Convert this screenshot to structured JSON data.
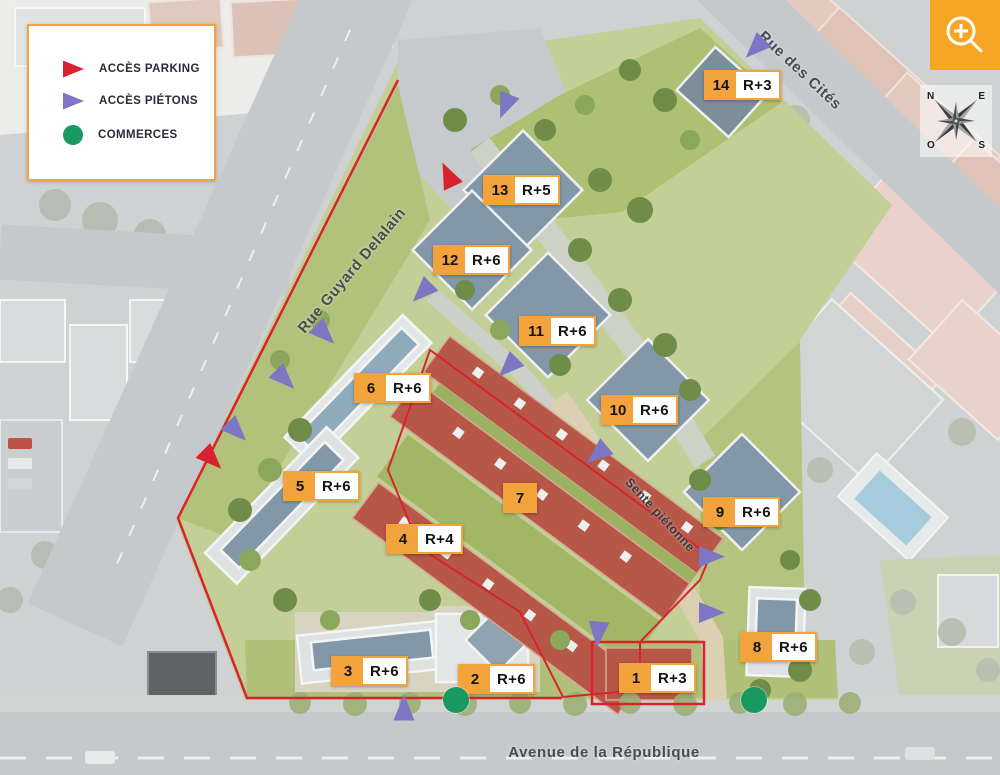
{
  "legend": {
    "items": [
      {
        "name": "acces-parking",
        "label": "ACCÈS PARKING",
        "icon": "red-arrow",
        "color": "#D8232E"
      },
      {
        "name": "acces-pietons",
        "label": "ACCÈS PIÉTONS",
        "icon": "purple-arrow",
        "color": "#7D76C5"
      },
      {
        "name": "commerces",
        "label": "COMMERCES",
        "icon": "green-circle",
        "color": "#18995F"
      }
    ]
  },
  "streets": {
    "rue_guyard_delalain": "Rue Guyard Delalain",
    "rue_des_cites": "Rue des Cités",
    "avenue_de_la_republique": "Avenue de la République",
    "sente_pietonne": "Sente piétonne"
  },
  "buildings": [
    {
      "num": "1",
      "height": "R+3"
    },
    {
      "num": "2",
      "height": "R+6"
    },
    {
      "num": "3",
      "height": "R+6"
    },
    {
      "num": "4",
      "height": "R+4"
    },
    {
      "num": "5",
      "height": "R+6"
    },
    {
      "num": "6",
      "height": "R+6"
    },
    {
      "num": "7",
      "height": ""
    },
    {
      "num": "8",
      "height": "R+6"
    },
    {
      "num": "9",
      "height": "R+6"
    },
    {
      "num": "10",
      "height": "R+6"
    },
    {
      "num": "11",
      "height": "R+6"
    },
    {
      "num": "12",
      "height": "R+6"
    },
    {
      "num": "13",
      "height": "R+5"
    },
    {
      "num": "14",
      "height": "R+3"
    }
  ],
  "compass": {
    "n": "N",
    "e": "E",
    "s": "S",
    "o": "O"
  },
  "controls": {
    "zoom_button_icon": "zoom-in-magnifier"
  },
  "colors": {
    "accent_orange": "#F2A33C",
    "parking_red": "#D8232E",
    "pedestrian_purple": "#7D76C5",
    "commerce_green": "#18995F",
    "boundary_red": "#D8232E"
  }
}
